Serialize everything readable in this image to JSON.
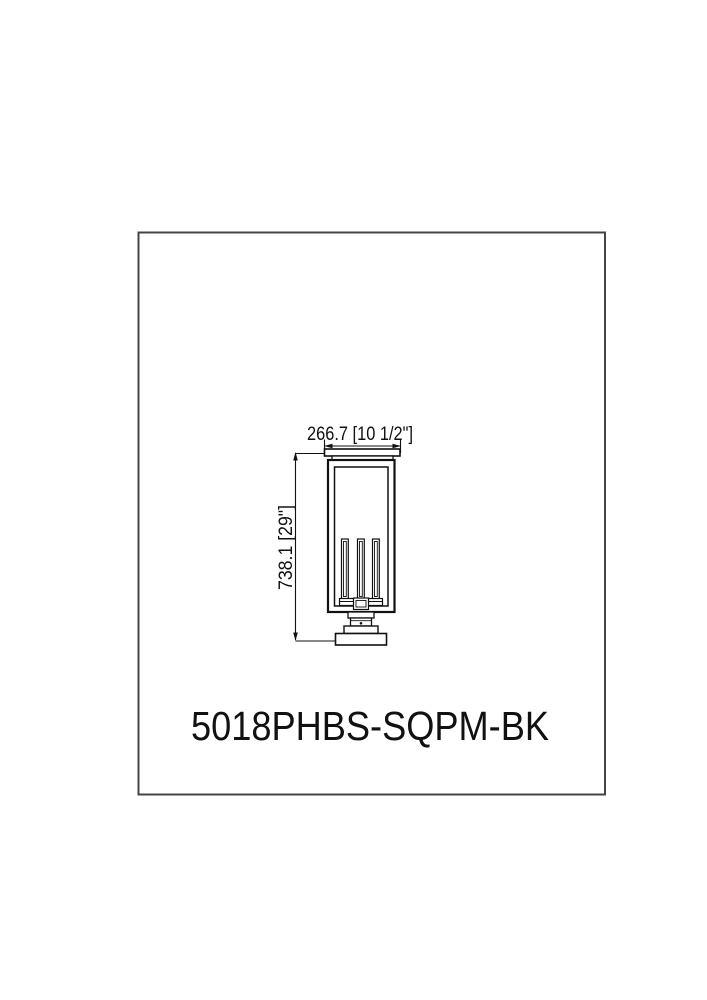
{
  "document": {
    "background_color": "#ffffff",
    "ink_color": "#111111",
    "border_color": "#444444"
  },
  "spec_drawing": {
    "model_number": "5018PHBS-SQPM-BK",
    "width_dimension_label": "266.7 [10 1/2\"]",
    "height_dimension_label": "738.1 [29\"]"
  }
}
